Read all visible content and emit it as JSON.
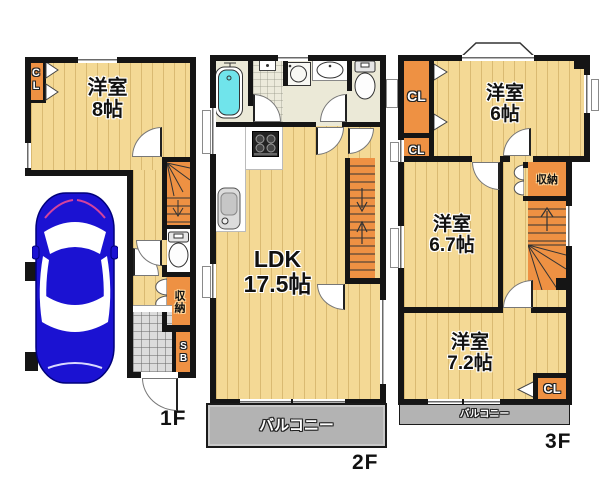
{
  "plan": {
    "floor1": {
      "label": "1F",
      "room": {
        "name": "洋室",
        "size": "8帖"
      },
      "closet": "CL",
      "storage": "収納",
      "shoe_box": "SB"
    },
    "floor2": {
      "label": "2F",
      "ldk": {
        "name": "LDK",
        "size": "17.5帖"
      },
      "balcony": "バルコニー"
    },
    "floor3": {
      "label": "3F",
      "room_top": {
        "name": "洋室",
        "size": "6帖"
      },
      "room_mid": {
        "name": "洋室",
        "size": "6.7帖"
      },
      "room_bottom": {
        "name": "洋室",
        "size": "7.2帖"
      },
      "closet_top": "CL",
      "closet_mid": "CL",
      "closet_bottom": "CL",
      "storage": "収納",
      "balcony": "バルコニー"
    },
    "colors": {
      "wall": "#151515",
      "wood_floor": "#f4d995",
      "closet_orange": "#ee9143",
      "sanitary_floor": "#ebe9d7",
      "bathtub": "#70e4eb",
      "balcony_gray": "#b3b3b3",
      "car_blue": "#1b12d2"
    }
  }
}
